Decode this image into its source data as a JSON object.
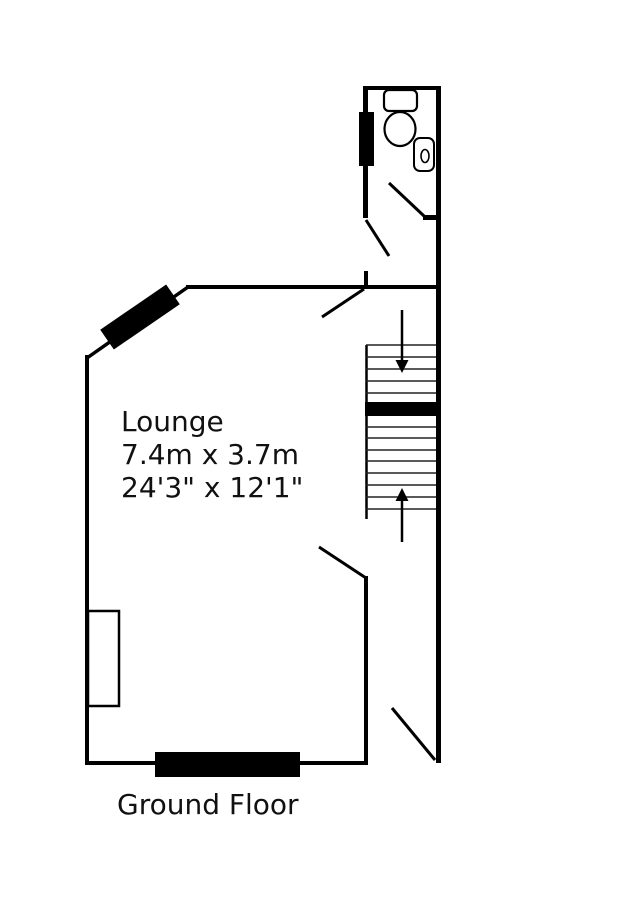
{
  "labels": {
    "room_name": "Lounge",
    "room_size_metric": "7.4m x 3.7m",
    "room_size_imperial": "24'3\" x 12'1\"",
    "floor": "Ground Floor"
  },
  "colors": {
    "background": "#ffffff",
    "wall": "#000000",
    "window_fill": "#000000",
    "tread_line": "#222222",
    "text": "#111111"
  },
  "fixtures": [
    "toilet-icon",
    "sink-icon",
    "staircase",
    "window-bar",
    "chimney-breast",
    "door-swing"
  ],
  "stairs": {
    "direction_arrows": [
      "down",
      "up"
    ]
  }
}
